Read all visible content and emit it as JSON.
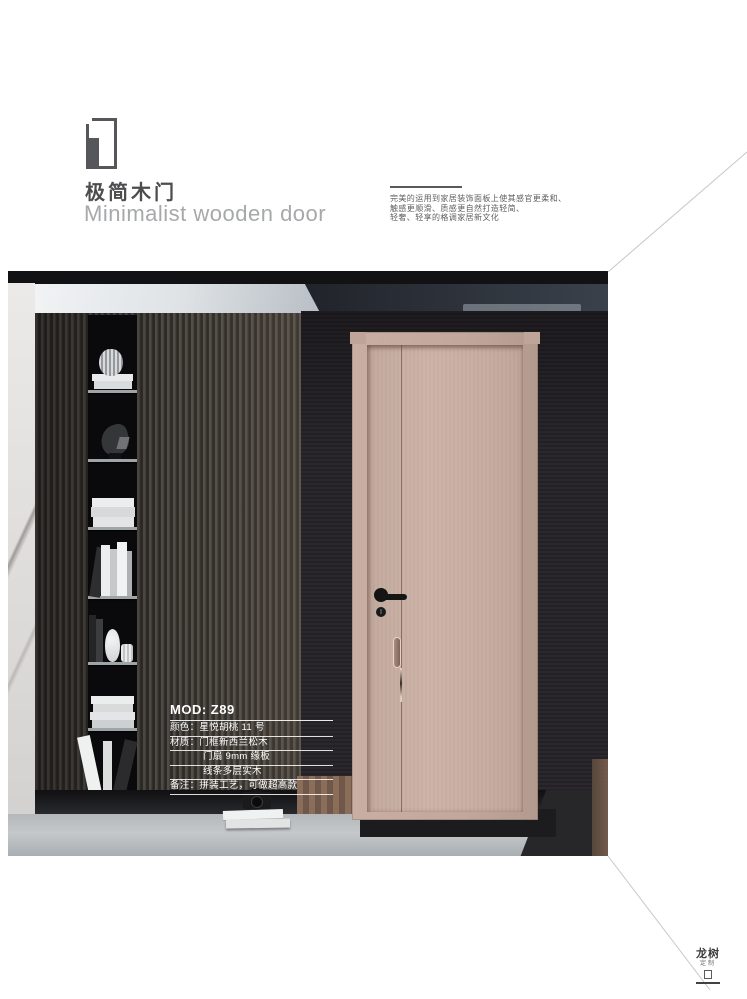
{
  "header": {
    "title_cn": "极简木门",
    "title_en": "Minimalist wooden door",
    "description_lines": [
      "完美的运用到家居装饰面板上使其感官更柔和、",
      "触感更顺滑、质感更自然打造轻简、",
      "轻奢、轻享的格调家居新文化"
    ]
  },
  "product": {
    "model": "MOD: Z89",
    "specs": [
      "颜色：星悦胡桃 11 号",
      "材质：门框新西兰松木",
      "门扇 9mm 缘板",
      "线条多层实木",
      "备注：拼装工艺，可做超高款"
    ]
  },
  "footer_logo": {
    "name": "龙树",
    "sub": "定制"
  },
  "colors": {
    "door": "#c9afa3",
    "door_wall": "#29262b",
    "slat_wall": "#3b3733",
    "title_dark": "#4c4d4f",
    "title_light": "#a6a8aa",
    "spec_text": "#ffffff"
  }
}
